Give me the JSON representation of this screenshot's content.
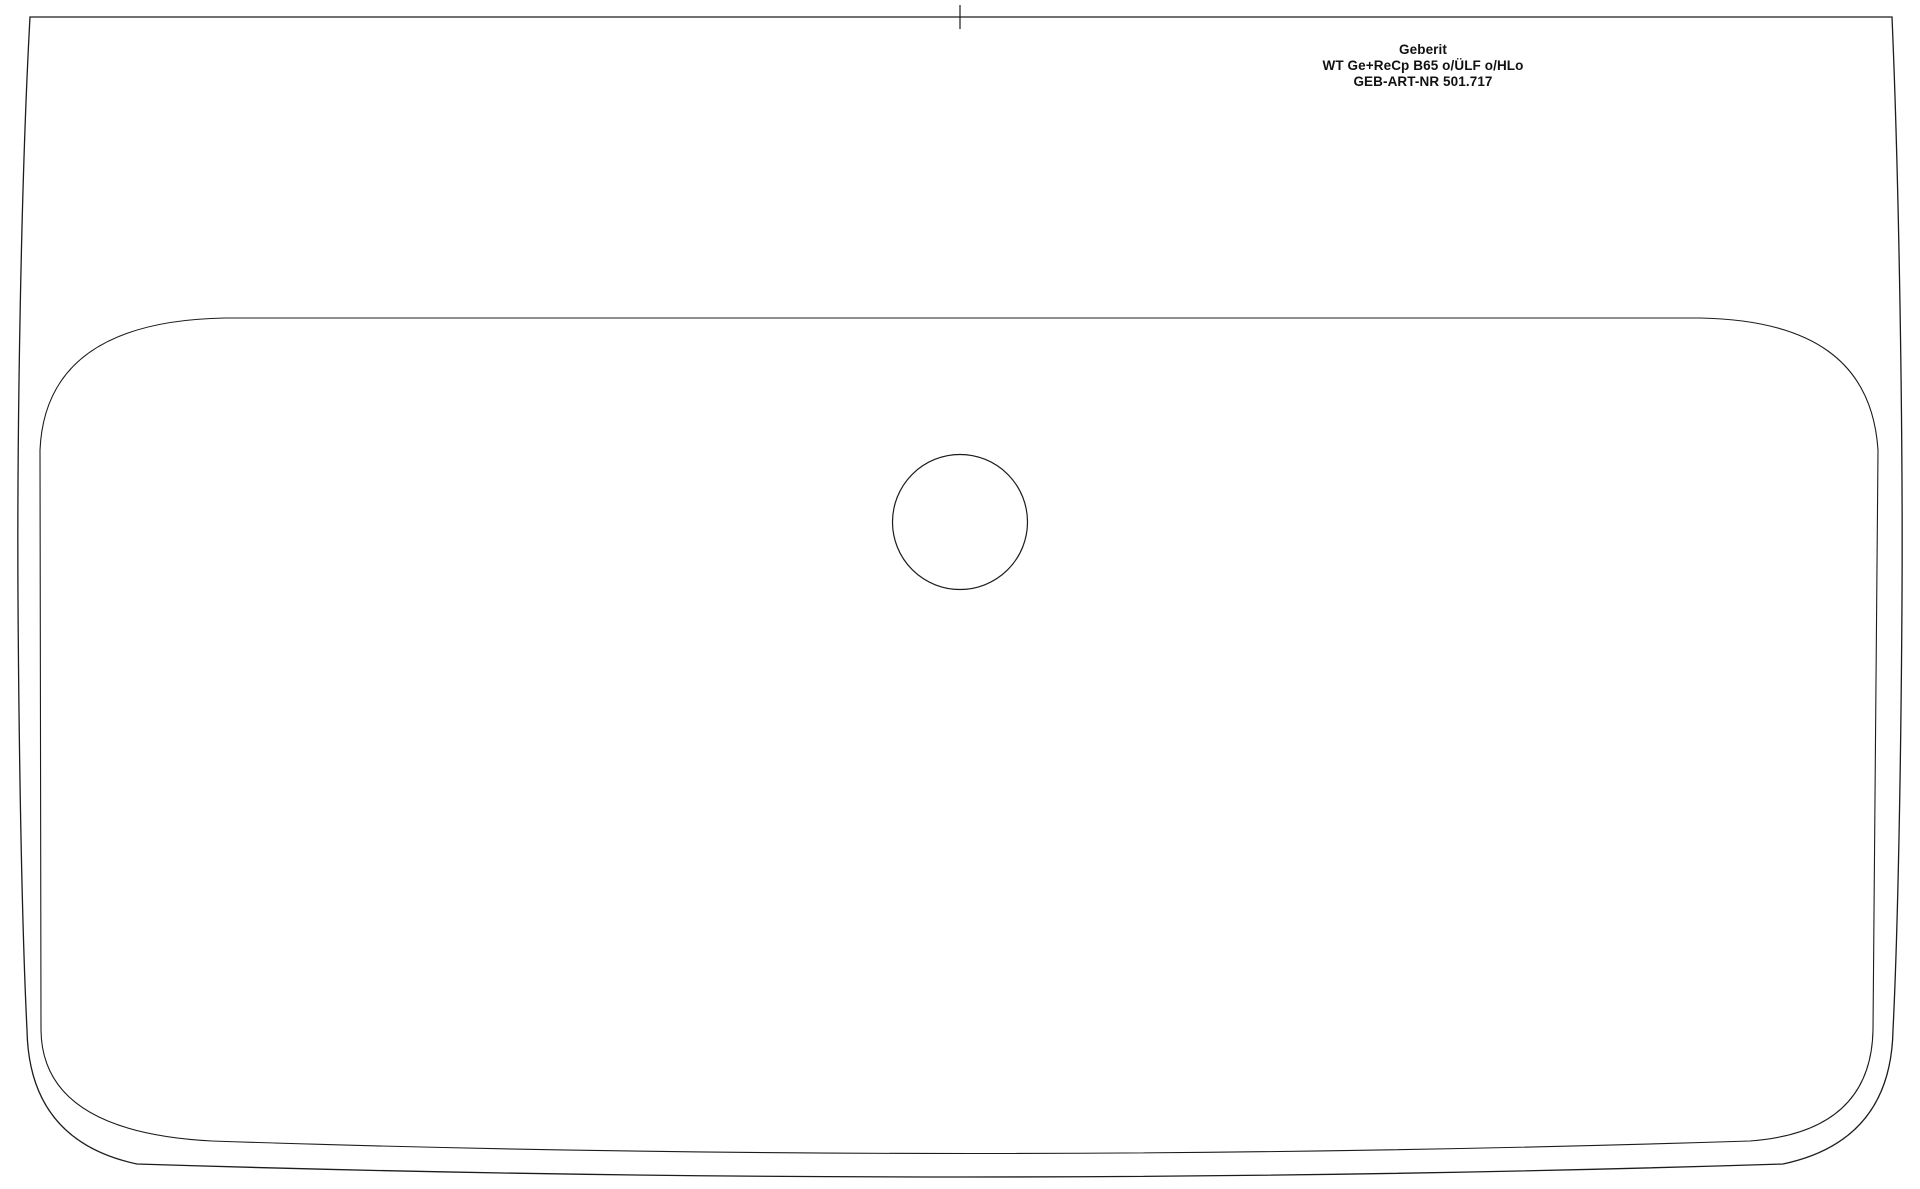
{
  "meta": {
    "view": "washbasin top view technical drawing",
    "background_color": "#ffffff",
    "line_color": "#1c1c1c",
    "text_color": "#111111"
  },
  "title_block": {
    "brand": "Geberit",
    "product": "WT Ge+ReCp B65 o/ÜLF o/HLo",
    "article_number": "GEB-ART-NR 501.717"
  }
}
